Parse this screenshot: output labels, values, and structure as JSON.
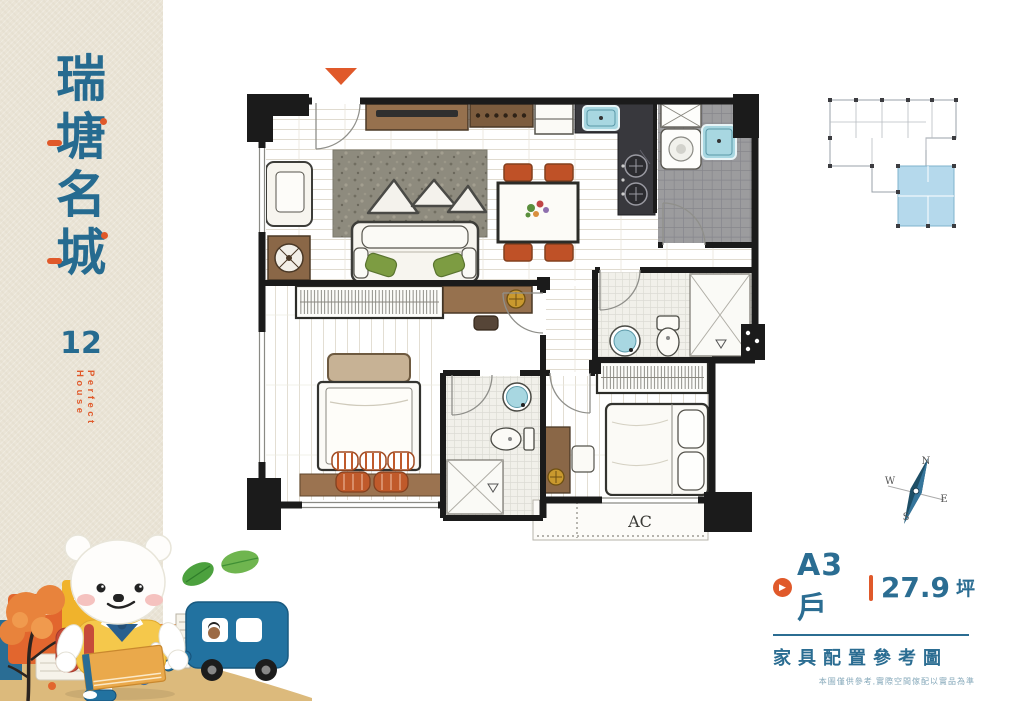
{
  "sidebar": {
    "title_chars": [
      "瑞",
      "塘",
      "名",
      "城"
    ],
    "project_number": "12",
    "tagline": "Perfect House"
  },
  "floor_plan": {
    "ac_label": "AC"
  },
  "compass": {
    "north": "N",
    "east": "E",
    "south": "S",
    "west": "W"
  },
  "info_panel": {
    "unit_label": "A3戶",
    "area_value": "27.9",
    "area_unit": "坪",
    "subtitle": "家具配置參考圖",
    "disclaimer": "本圖僅供參考,實際空間傢配以實品為準"
  },
  "colors": {
    "brand_blue": "#266b90",
    "brand_orange": "#e0592a",
    "paper_beige": "#eae4d6",
    "keyplan_highlight": "#b5d9ec",
    "sand": "#dcba7c"
  }
}
